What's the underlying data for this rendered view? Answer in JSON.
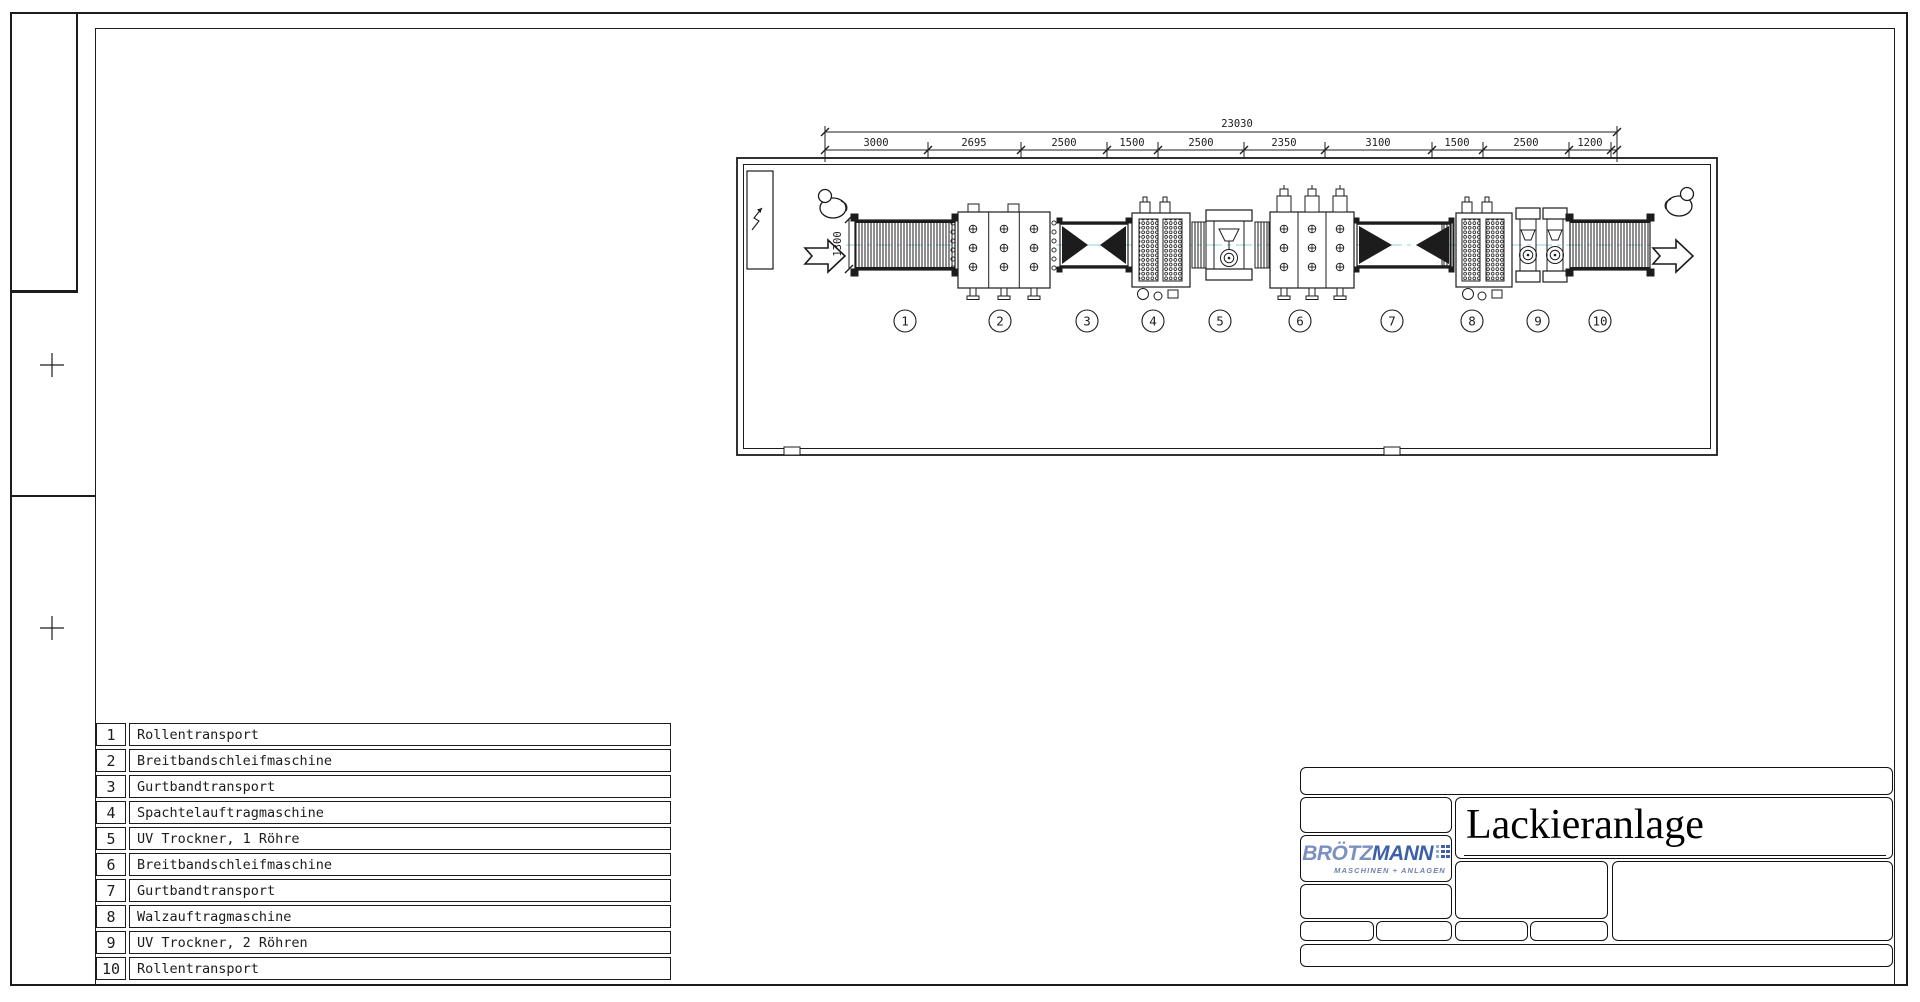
{
  "dimensions": {
    "total": "23030",
    "segments": [
      "3000",
      "2695",
      "2500",
      "1500",
      "2500",
      "2350",
      "3100",
      "1500",
      "2500",
      "1200"
    ],
    "entry_width": "1300"
  },
  "legend": {
    "items": [
      {
        "no": "1",
        "label": "Rollentransport"
      },
      {
        "no": "2",
        "label": "Breitbandschleifmaschine"
      },
      {
        "no": "3",
        "label": "Gurtbandtransport"
      },
      {
        "no": "4",
        "label": "Spachtelauftragmaschine"
      },
      {
        "no": "5",
        "label": "UV Trockner, 1 Röhre"
      },
      {
        "no": "6",
        "label": "Breitbandschleifmaschine"
      },
      {
        "no": "7",
        "label": "Gurtbandtransport"
      },
      {
        "no": "8",
        "label": "Walzauftragmaschine"
      },
      {
        "no": "9",
        "label": "UV Trockner, 2 Röhren"
      },
      {
        "no": "10",
        "label": "Rollentransport"
      }
    ]
  },
  "titleblock": {
    "title": "Lackieranlage",
    "logo": {
      "light": "BRÖTZ",
      "bold": "MANN",
      "subtitle": "MASCHINEN + ANLAGEN"
    }
  },
  "colors": {
    "line": "#1c1c1c",
    "centerline": "#8fd2d8",
    "logo_light": "#7b8fc0",
    "logo_dark": "#3c5fa9"
  }
}
